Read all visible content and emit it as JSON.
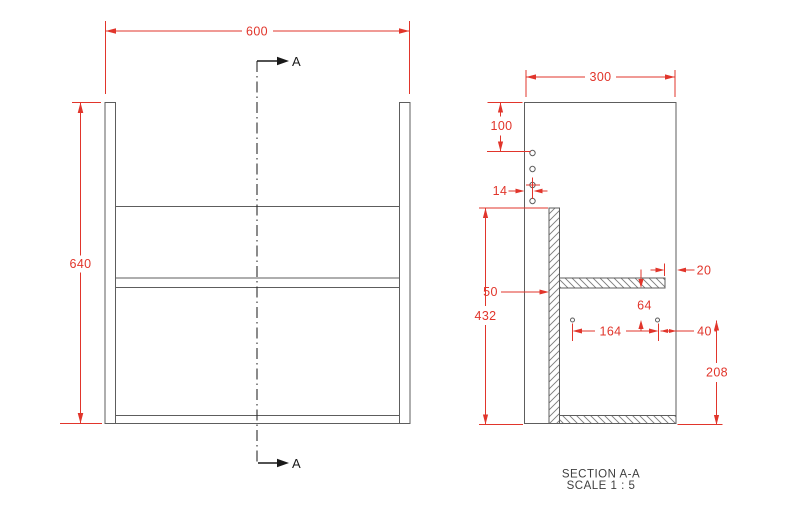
{
  "page": {
    "background": "#ffffff"
  },
  "drawing": {
    "colors": {
      "dimension_red": "#e1352b",
      "outline_gray": "#5d5d5d",
      "annotation_black": "#191919",
      "title_gray": "#3f3f3f"
    },
    "front_view": {
      "width_dim": "600",
      "height_dim": "640",
      "section_marker_top": "A",
      "section_marker_bottom": "A"
    },
    "section_view": {
      "depth_dim": "300",
      "top_to_first_hole_dim": "100",
      "hole_front_offset_dim": "14",
      "back_panel_inset_dim": "50",
      "back_panel_height_dim": "432",
      "shelf_setback_dim": "20",
      "shelf_to_holes_dim": "64",
      "hole_spacing_dim": "164",
      "hole_to_front_dim": "40",
      "holes_to_bottom_dim": "208"
    },
    "title": {
      "name": "SECTION A-A",
      "scale": "SCALE 1 : 5"
    }
  }
}
